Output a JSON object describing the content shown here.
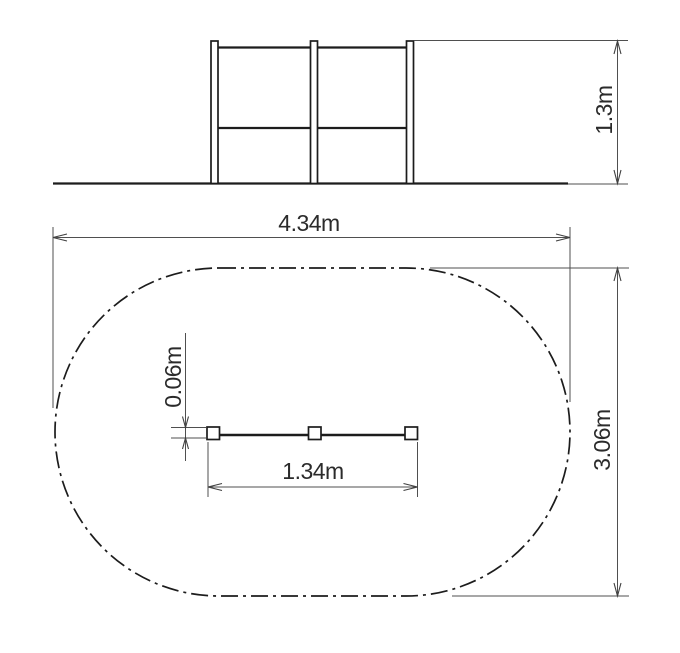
{
  "drawing": {
    "title": "playground-equipment-dimension-drawing",
    "elevation": {
      "height_label": "1.3m"
    },
    "plan": {
      "width_label": "4.34m",
      "depth_label": "3.06m",
      "bar_length_label": "1.34m",
      "post_size_label": "0.06m"
    },
    "colors": {
      "background": "#ffffff",
      "object_line": "#1c1c1c",
      "dimension_line": "#4f4f4f",
      "label_text": "#2b2b2b"
    }
  }
}
